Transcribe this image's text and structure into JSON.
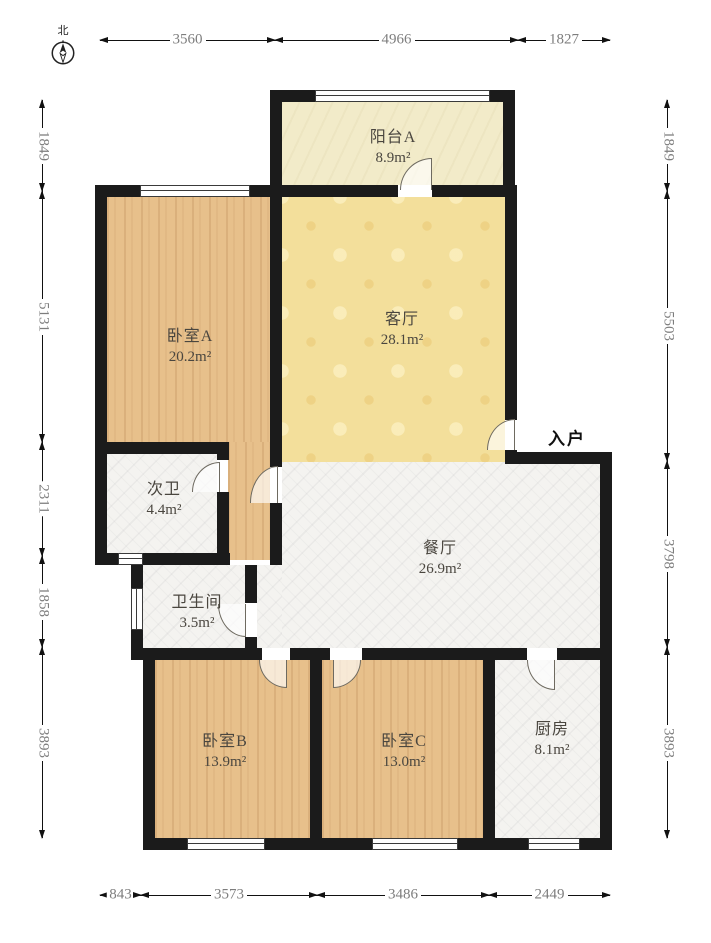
{
  "compass": {
    "label": "北"
  },
  "entrance": {
    "label": "入户"
  },
  "rooms": [
    {
      "key": "balcony-a",
      "name": "阳台A",
      "area": "8.9m²"
    },
    {
      "key": "living-room",
      "name": "客厅",
      "area": "28.1m²"
    },
    {
      "key": "bedroom-a",
      "name": "卧室A",
      "area": "20.2m²"
    },
    {
      "key": "second-bath",
      "name": "次卫",
      "area": "4.4m²"
    },
    {
      "key": "dining-room",
      "name": "餐厅",
      "area": "26.9m²"
    },
    {
      "key": "bathroom",
      "name": "卫生间",
      "area": "3.5m²"
    },
    {
      "key": "bedroom-b",
      "name": "卧室B",
      "area": "13.9m²"
    },
    {
      "key": "bedroom-c",
      "name": "卧室C",
      "area": "13.0m²"
    },
    {
      "key": "kitchen",
      "name": "厨房",
      "area": "8.1m²"
    }
  ],
  "dimensions": {
    "top": [
      "3560",
      "4966",
      "1827"
    ],
    "bottom": [
      "843",
      "3573",
      "3486",
      "2449"
    ],
    "left": [
      "1849",
      "5131",
      "2311",
      "1858",
      "3893"
    ],
    "right": [
      "1849",
      "5503",
      "3798",
      "3893"
    ]
  },
  "colors": {
    "wall": "#1b1b1b",
    "wood": "#e7c08b",
    "living": "#f3df9b",
    "marble": "#f4f3f0",
    "balcony": "#f2ebc9",
    "dim_text": "#7d7d7d",
    "label_text": "#4a463f"
  }
}
